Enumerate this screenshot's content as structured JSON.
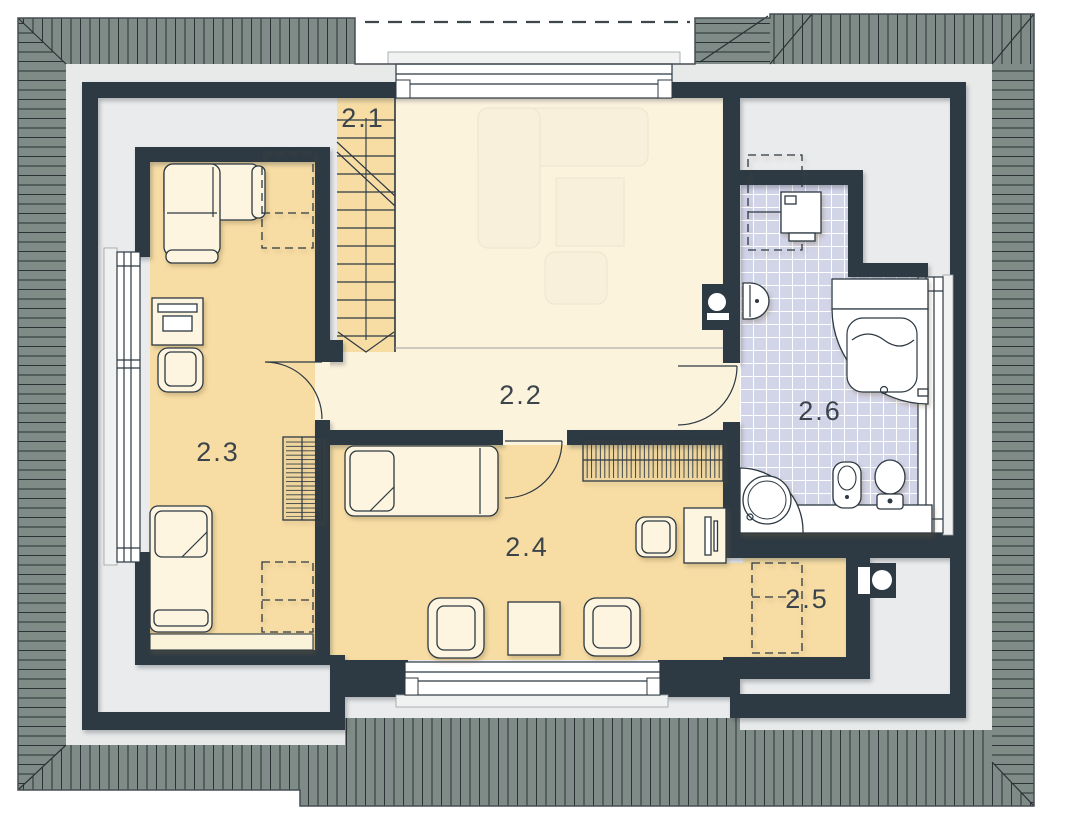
{
  "plan": {
    "type": "attic-floor-plan",
    "rooms": [
      {
        "label": "2.1",
        "kind": "staircase"
      },
      {
        "label": "2.2",
        "kind": "hallway"
      },
      {
        "label": "2.3",
        "kind": "bedroom"
      },
      {
        "label": "2.4",
        "kind": "bedroom"
      },
      {
        "label": "2.5",
        "kind": "storage"
      },
      {
        "label": "2.6",
        "kind": "bathroom"
      }
    ],
    "palette": {
      "wall": "#2e3a43",
      "roof": "#7e8b86",
      "roof_line": "#2b3134",
      "room_warm": "#f7dda4",
      "room_light": "#fcf3dd",
      "bath_tile": "#d2d4e8",
      "under_eaves": "#e9ebec",
      "furniture": "#fdf5df",
      "label_text": "#3c444b"
    }
  }
}
